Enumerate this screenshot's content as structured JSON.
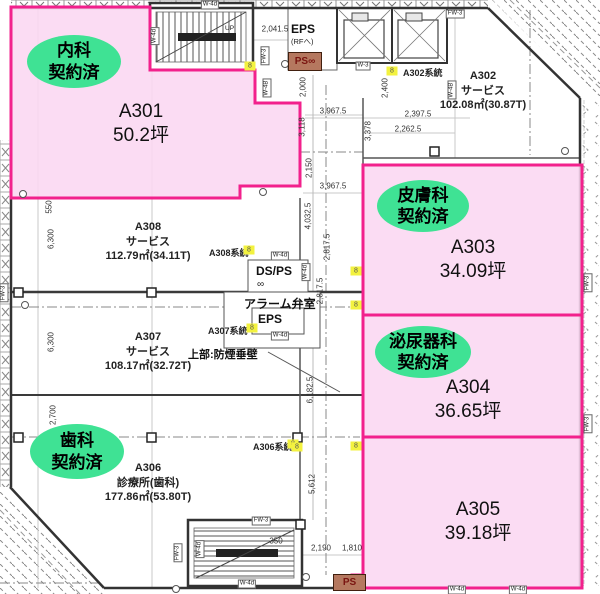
{
  "title": "医療モール フロア図面(3F 区画図)",
  "colors": {
    "suite_fill": "#fbd7f1",
    "suite_border": "#f2218c",
    "contract_badge": "#3fe294",
    "shaft_fill": "#b5785f",
    "shaft_text": "#7a1410",
    "highlight": "#f3f23f"
  },
  "suites": {
    "a301": {
      "id": "A301",
      "size": "50.2坪",
      "specialty": "内科",
      "status": "契約済"
    },
    "a302": {
      "id": "A302",
      "use": "サービス",
      "area": "102.08㎡(30.87T)"
    },
    "a303": {
      "id": "A303",
      "size": "34.09坪",
      "specialty": "皮膚科",
      "status": "契約済"
    },
    "a304": {
      "id": "A304",
      "size": "36.65坪",
      "specialty": "泌尿器科",
      "status": "契約済"
    },
    "a305": {
      "id": "A305",
      "size": "39.18坪"
    },
    "a306": {
      "id": "A306",
      "use": "診療所(歯科)",
      "area": "177.86㎡(53.80T)",
      "specialty": "歯科",
      "status": "契約済"
    },
    "a307": {
      "id": "A307",
      "use": "サービス",
      "area": "108.17㎡(32.72T)"
    },
    "a308": {
      "id": "A308",
      "use": "サービス",
      "area": "112.79㎡(34.11T)"
    }
  },
  "annotations": {
    "eps_top": "EPS",
    "eps_top_sub": "(RFへ)",
    "ps_top": "PS∞",
    "ps_bottom": "PS",
    "ds_ps": "DS/PS",
    "infinity": "∞",
    "alarm_room": "アラーム弁室",
    "eps_mid": "EPS",
    "smoke_wall": "上部:防煙垂壁",
    "up": "UP",
    "sys_a302": "A302系統",
    "sys_a306": "A306系統",
    "sys_a307": "A307系統",
    "sys_a308": "A308系統"
  },
  "dimensions_mm": [
    {
      "t": "2,041.5",
      "x": 275,
      "y": 29,
      "r": "h"
    },
    {
      "t": "3,967.5",
      "x": 333,
      "y": 111,
      "r": "h"
    },
    {
      "t": "2,397.5",
      "x": 418,
      "y": 114,
      "r": "h"
    },
    {
      "t": "2,262.5",
      "x": 408,
      "y": 129,
      "r": "h"
    },
    {
      "t": "3,967.5",
      "x": 333,
      "y": 186,
      "r": "h"
    },
    {
      "t": "2,190",
      "x": 321,
      "y": 548,
      "r": "h"
    },
    {
      "t": "1,810",
      "x": 352,
      "y": 548,
      "r": "h"
    },
    {
      "t": "350",
      "x": 276,
      "y": 541,
      "r": "h"
    },
    {
      "t": "2,000",
      "x": 303,
      "y": 87,
      "r": "v"
    },
    {
      "t": "3,118",
      "x": 302,
      "y": 127,
      "r": "v"
    },
    {
      "t": "2,150",
      "x": 309,
      "y": 168,
      "r": "v"
    },
    {
      "t": "2,400",
      "x": 385,
      "y": 88,
      "r": "v"
    },
    {
      "t": "3,378",
      "x": 368,
      "y": 131,
      "r": "v"
    },
    {
      "t": "4,032.5",
      "x": 308,
      "y": 216,
      "r": "v"
    },
    {
      "t": "2,817.5",
      "x": 327,
      "y": 247,
      "r": "v"
    },
    {
      "t": "2,817.5",
      "x": 320,
      "y": 291,
      "r": "v"
    },
    {
      "t": "6,182.5",
      "x": 310,
      "y": 390,
      "r": "v"
    },
    {
      "t": "5,612",
      "x": 312,
      "y": 484,
      "r": "v"
    },
    {
      "t": "550",
      "x": 49,
      "y": 207,
      "r": "v"
    },
    {
      "t": "6,300",
      "x": 51,
      "y": 239,
      "r": "v"
    },
    {
      "t": "6,300",
      "x": 51,
      "y": 342,
      "r": "v"
    },
    {
      "t": "2,700",
      "x": 53,
      "y": 415,
      "r": "v"
    }
  ],
  "wall_tags": [
    {
      "t": "W-4d",
      "x": 210,
      "y": 5,
      "r": "h"
    },
    {
      "t": "W-4d",
      "x": 155,
      "y": 36,
      "r": "v"
    },
    {
      "t": "W-3",
      "x": 363,
      "y": 66,
      "r": "h"
    },
    {
      "t": "FW-3",
      "x": 455,
      "y": 14,
      "r": "h"
    },
    {
      "t": "FW-3",
      "x": 265,
      "y": 56,
      "r": "v"
    },
    {
      "t": "W-4B",
      "x": 267,
      "y": 88,
      "r": "v"
    },
    {
      "t": "W-4B",
      "x": 452,
      "y": 90,
      "r": "v"
    },
    {
      "t": "W-4d",
      "x": 280,
      "y": 256,
      "r": "h"
    },
    {
      "t": "W-4d",
      "x": 306,
      "y": 272,
      "r": "v"
    },
    {
      "t": "W-4d",
      "x": 280,
      "y": 336,
      "r": "h"
    },
    {
      "t": "FW-3",
      "x": 4,
      "y": 293,
      "r": "v"
    },
    {
      "t": "FW-3",
      "x": 588,
      "y": 283,
      "r": "v"
    },
    {
      "t": "FW-3",
      "x": 588,
      "y": 424,
      "r": "v"
    },
    {
      "t": "FW-3",
      "x": 261,
      "y": 521,
      "r": "h"
    },
    {
      "t": "W-4d",
      "x": 247,
      "y": 584,
      "r": "h"
    },
    {
      "t": "W-4d",
      "x": 200,
      "y": 549,
      "r": "v"
    },
    {
      "t": "FW-3",
      "x": 178,
      "y": 553,
      "r": "v"
    },
    {
      "t": "W-4d",
      "x": 457,
      "y": 590,
      "r": "h"
    },
    {
      "t": "W-4d",
      "x": 518,
      "y": 590,
      "r": "h"
    }
  ],
  "system_markers": [
    {
      "x": 392,
      "y": 71
    },
    {
      "x": 249,
      "y": 250
    },
    {
      "x": 252,
      "y": 328
    },
    {
      "x": 293,
      "y": 444
    },
    {
      "x": 250,
      "y": 66
    },
    {
      "x": 356,
      "y": 271
    },
    {
      "x": 356,
      "y": 305
    },
    {
      "x": 297,
      "y": 447
    },
    {
      "x": 356,
      "y": 446
    }
  ]
}
